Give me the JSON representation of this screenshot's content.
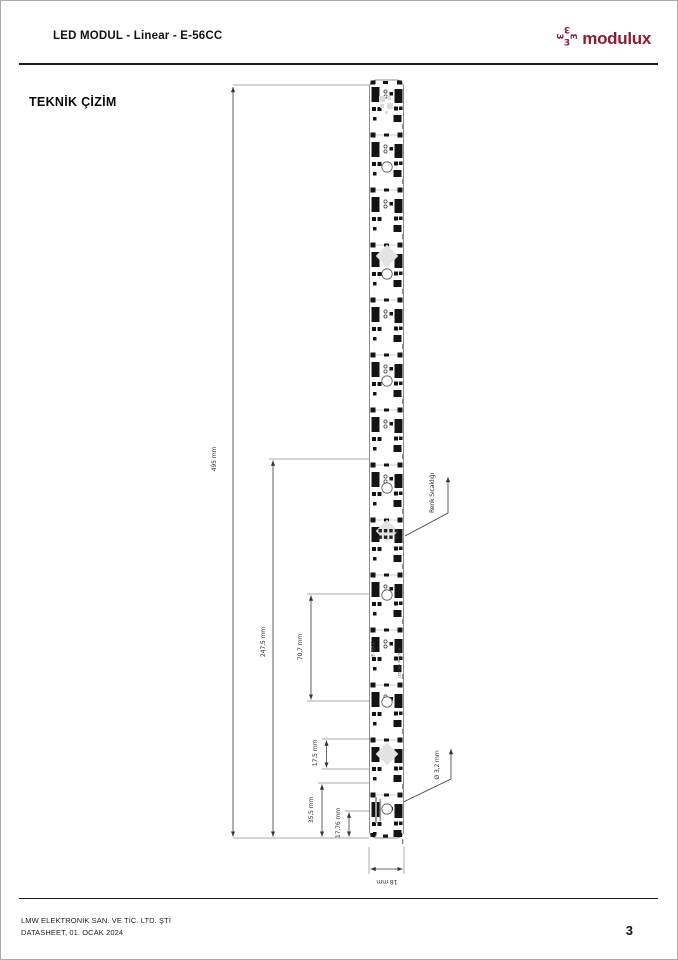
{
  "header": {
    "title": "LED MODUL - Linear - E-56CC",
    "logo_text": "modulux"
  },
  "section": {
    "title": "TEKNİK ÇİZİM"
  },
  "drawing": {
    "dim_overall_length": "495 mm",
    "dim_half_length": "247,5 mm",
    "dim_hole_pitch": "70,7 mm",
    "dim_led_pitch": "17,5 mm",
    "dim_module_pitch": "35,5 mm",
    "dim_hole_to_end": "17,76 mm",
    "dim_width": "18 mm",
    "dim_hole_diameter": "Ø 3,2 mm",
    "callout_color_temp": "Renk Sıcaklığı",
    "pcb_marking_model": "E-56CC",
    "pcb_marking_series": "LED BAR MODULE",
    "module_count": 14
  },
  "footer": {
    "company": "LMW ELEKTRONİK SAN. VE TİC. LTD. ŞTİ",
    "edition": "DATASHEET, 01. OCAK 2024",
    "page_number": "3"
  },
  "colors": {
    "accent": "#8e1d32",
    "component": "#141414",
    "dimension_line": "#3a3a3a"
  }
}
